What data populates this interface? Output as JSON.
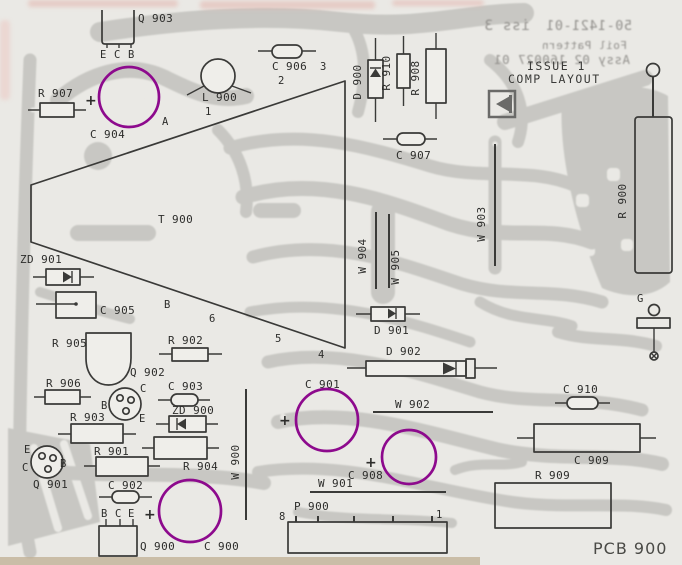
{
  "doc": {
    "part_number": "50-1421-01",
    "issue_rev": "iss 3",
    "foil_pattern_label": "Foil Pattern",
    "assembly": "Assy 02 160027 01",
    "issue_stamp": "ISSUE 1",
    "layout_stamp": "COMP LAYOUT",
    "board_name": "PCB 900"
  },
  "components": {
    "q903": "Q 903",
    "r907": "R 907",
    "c904": "C 904",
    "l900": "L 900",
    "c906": "C 906",
    "d900": "D 900",
    "r910": "R 910",
    "r908": "R 908",
    "c907": "C 907",
    "t900": "T 900",
    "zd901": "ZD 901",
    "c905": "C 905",
    "r905": "R 905",
    "r902": "R 902",
    "r906": "R 906",
    "q902": "Q 902",
    "c903": "C 903",
    "zd900": "ZD 900",
    "r903": "R 903",
    "r904": "R 904",
    "q901": "Q 901",
    "r901": "R 901",
    "c902": "C 902",
    "q900": "Q 900",
    "c900": "C 900",
    "w900": "W 900",
    "p900": "P 900",
    "w901": "W 901",
    "c901": "C 901",
    "c908": "C 908",
    "w902": "W 902",
    "d902": "D 902",
    "d901": "D 901",
    "w904": "W 904",
    "w905": "W 905",
    "w903": "W 903",
    "r900": "R 900",
    "c910": "C 910",
    "c909": "C 909",
    "r909": "R 909"
  },
  "pins": {
    "e": "E",
    "c": "C",
    "b": "B",
    "g": "G",
    "plus": "+"
  },
  "pads": {
    "a": "A",
    "p1": "1",
    "p2": "2",
    "p3": "3",
    "p4": "4",
    "p5": "5",
    "p6": "6",
    "p8": "8"
  },
  "annotations": {
    "highlighted_components": [
      "C 904",
      "C 901",
      "C 908",
      "C 900"
    ]
  },
  "colors": {
    "annotation": "#8d0a8d",
    "trace": "#c8c7c3",
    "outline": "#3a3a38",
    "paper": "#eae9e5"
  }
}
